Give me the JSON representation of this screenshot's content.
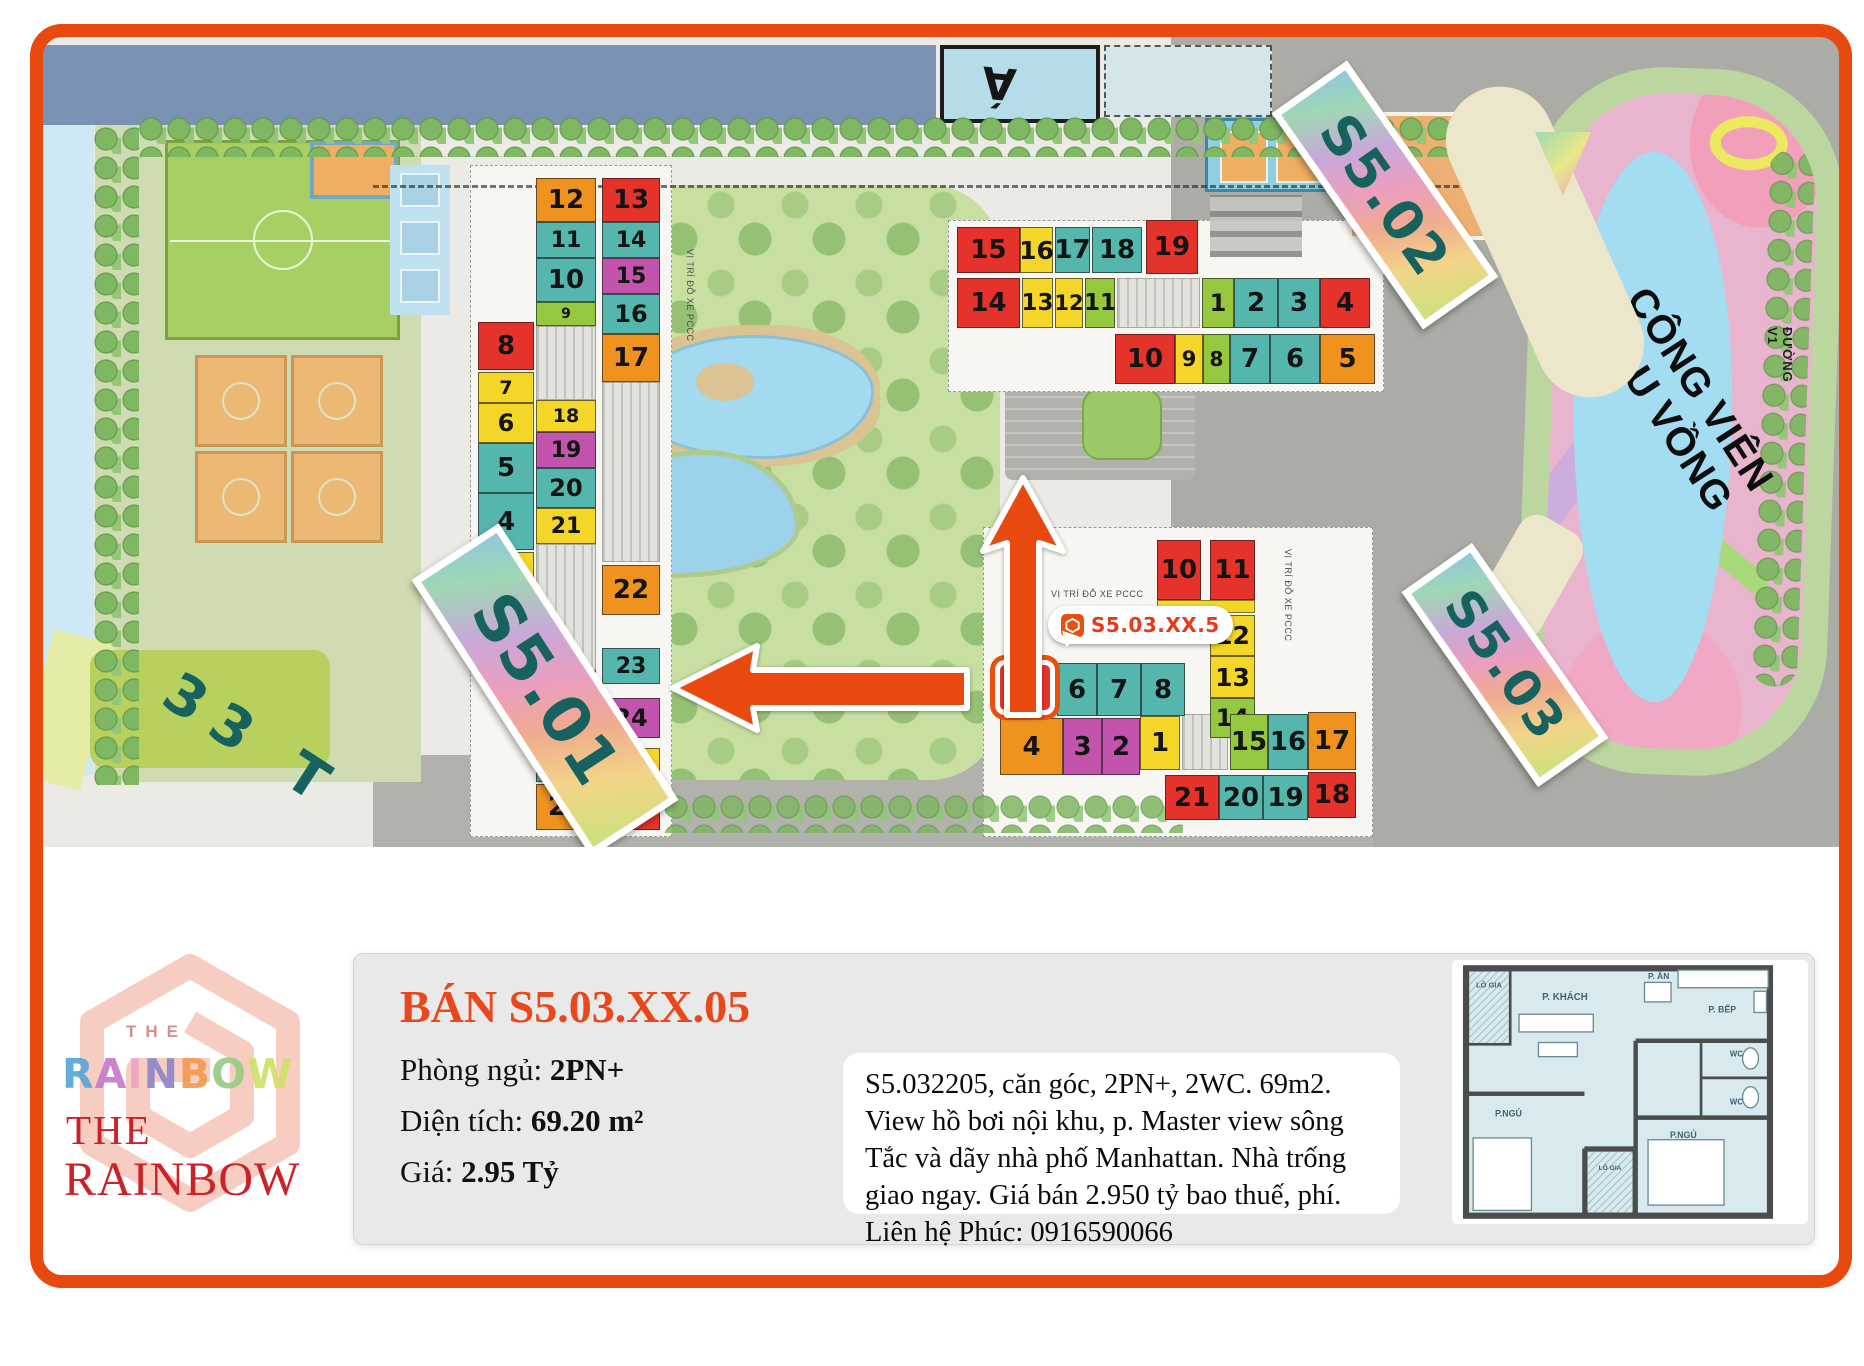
{
  "frame_color": "#e8490f",
  "map": {
    "pool_text": "Á",
    "tower_labels": {
      "s501": "S5.01",
      "s502": "S5.02",
      "s503": "S5.03"
    },
    "floors_label": "33 T",
    "park_name_line1": "CÔNG VIÊN",
    "park_name_line2": "CẦU VỒNG",
    "road_label": "ĐƯỜNG V1",
    "parking_note": "VỊ TRÍ ĐỖ XE PCCC",
    "unit_badge": {
      "text": "S5.03.XX.5"
    },
    "unit_colors": {
      "r": "#e5332b",
      "o": "#f0921e",
      "y": "#f3d627",
      "t": "#54b6ad",
      "g": "#95c83e",
      "m": "#c354ae"
    },
    "buildings": [
      {
        "id": "s501",
        "units": [
          {
            "n": "8",
            "c": "r",
            "x": 435,
            "y": 285,
            "w": 56,
            "h": 48
          },
          {
            "n": "7",
            "c": "y",
            "x": 435,
            "y": 335,
            "w": 56,
            "h": 31
          },
          {
            "n": "6",
            "c": "y",
            "x": 435,
            "y": 366,
            "w": 56,
            "h": 40
          },
          {
            "n": "5",
            "c": "t",
            "x": 435,
            "y": 406,
            "w": 56,
            "h": 50
          },
          {
            "n": "4",
            "c": "t",
            "x": 435,
            "y": 456,
            "w": 56,
            "h": 57
          },
          {
            "n": "3",
            "c": "y",
            "x": 435,
            "y": 515,
            "w": 56,
            "h": 36
          },
          {
            "n": "2",
            "c": "y",
            "x": 435,
            "y": 551,
            "w": 56,
            "h": 40
          },
          {
            "n": "1",
            "c": "r",
            "x": 435,
            "y": 593,
            "w": 56,
            "h": 50
          },
          {
            "n": "12",
            "c": "o",
            "x": 493,
            "y": 141,
            "w": 60,
            "h": 44
          },
          {
            "n": "11",
            "c": "t",
            "x": 493,
            "y": 185,
            "w": 60,
            "h": 36
          },
          {
            "n": "10",
            "c": "t",
            "x": 493,
            "y": 221,
            "w": 60,
            "h": 44
          },
          {
            "n": "9",
            "c": "g",
            "x": 493,
            "y": 265,
            "w": 60,
            "h": 24
          },
          {
            "n": "18",
            "c": "y",
            "x": 493,
            "y": 363,
            "w": 60,
            "h": 32
          },
          {
            "n": "19",
            "c": "m",
            "x": 493,
            "y": 395,
            "w": 60,
            "h": 36
          },
          {
            "n": "20",
            "c": "t",
            "x": 493,
            "y": 431,
            "w": 60,
            "h": 40
          },
          {
            "n": "21",
            "c": "y",
            "x": 493,
            "y": 471,
            "w": 60,
            "h": 36
          },
          {
            "n": "30",
            "c": "g",
            "x": 493,
            "y": 633,
            "w": 60,
            "h": 26
          },
          {
            "n": "29",
            "c": "t",
            "x": 493,
            "y": 659,
            "w": 60,
            "h": 42
          },
          {
            "n": "28",
            "c": "t",
            "x": 493,
            "y": 703,
            "w": 60,
            "h": 42
          },
          {
            "n": "27",
            "c": "o",
            "x": 493,
            "y": 747,
            "w": 60,
            "h": 46
          },
          {
            "n": "13",
            "c": "r",
            "x": 559,
            "y": 141,
            "w": 58,
            "h": 44
          },
          {
            "n": "14",
            "c": "t",
            "x": 559,
            "y": 185,
            "w": 58,
            "h": 36
          },
          {
            "n": "15",
            "c": "m",
            "x": 559,
            "y": 221,
            "w": 58,
            "h": 36
          },
          {
            "n": "16",
            "c": "t",
            "x": 559,
            "y": 257,
            "w": 58,
            "h": 40
          },
          {
            "n": "17",
            "c": "o",
            "x": 559,
            "y": 297,
            "w": 58,
            "h": 48
          },
          {
            "n": "22",
            "c": "o",
            "x": 559,
            "y": 528,
            "w": 58,
            "h": 50
          },
          {
            "n": "23",
            "c": "t",
            "x": 559,
            "y": 611,
            "w": 58,
            "h": 36
          },
          {
            "n": "24",
            "c": "m",
            "x": 559,
            "y": 661,
            "w": 58,
            "h": 40
          },
          {
            "n": "25",
            "c": "y",
            "x": 559,
            "y": 711,
            "w": 58,
            "h": 36
          },
          {
            "n": "26",
            "c": "r",
            "x": 559,
            "y": 751,
            "w": 58,
            "h": 42
          }
        ]
      },
      {
        "id": "s502",
        "units": [
          {
            "n": "15",
            "c": "r",
            "x": 914,
            "y": 190,
            "w": 63,
            "h": 46
          },
          {
            "n": "16",
            "c": "y",
            "x": 977,
            "y": 190,
            "w": 33,
            "h": 46
          },
          {
            "n": "17",
            "c": "t",
            "x": 1012,
            "y": 190,
            "w": 35,
            "h": 46
          },
          {
            "n": "18",
            "c": "t",
            "x": 1049,
            "y": 190,
            "w": 50,
            "h": 46
          },
          {
            "n": "19",
            "c": "r",
            "x": 1103,
            "y": 183,
            "w": 52,
            "h": 54
          },
          {
            "n": "14",
            "c": "r",
            "x": 914,
            "y": 241,
            "w": 63,
            "h": 50
          },
          {
            "n": "13",
            "c": "y",
            "x": 979,
            "y": 241,
            "w": 31,
            "h": 50
          },
          {
            "n": "12",
            "c": "y",
            "x": 1012,
            "y": 241,
            "w": 28,
            "h": 50
          },
          {
            "n": "11",
            "c": "g",
            "x": 1042,
            "y": 241,
            "w": 30,
            "h": 50
          },
          {
            "n": "1",
            "c": "g",
            "x": 1159,
            "y": 241,
            "w": 32,
            "h": 50
          },
          {
            "n": "2",
            "c": "t",
            "x": 1191,
            "y": 241,
            "w": 44,
            "h": 50
          },
          {
            "n": "3",
            "c": "t",
            "x": 1235,
            "y": 241,
            "w": 42,
            "h": 50
          },
          {
            "n": "4",
            "c": "r",
            "x": 1277,
            "y": 241,
            "w": 50,
            "h": 50
          },
          {
            "n": "10",
            "c": "r",
            "x": 1072,
            "y": 297,
            "w": 60,
            "h": 50
          },
          {
            "n": "9",
            "c": "y",
            "x": 1132,
            "y": 297,
            "w": 28,
            "h": 50
          },
          {
            "n": "8",
            "c": "g",
            "x": 1160,
            "y": 297,
            "w": 27,
            "h": 50
          },
          {
            "n": "7",
            "c": "t",
            "x": 1187,
            "y": 297,
            "w": 40,
            "h": 50
          },
          {
            "n": "6",
            "c": "t",
            "x": 1227,
            "y": 297,
            "w": 50,
            "h": 50
          },
          {
            "n": "5",
            "c": "o",
            "x": 1277,
            "y": 297,
            "w": 55,
            "h": 50
          }
        ]
      },
      {
        "id": "s503",
        "strips": [
          {
            "c": "y",
            "x": 1114,
            "y": 563,
            "w": 98,
            "h": 13
          }
        ],
        "units": [
          {
            "n": "10",
            "c": "r",
            "x": 1114,
            "y": 503,
            "w": 44,
            "h": 60
          },
          {
            "n": "11",
            "c": "r",
            "x": 1167,
            "y": 503,
            "w": 45,
            "h": 60
          },
          {
            "n": "12",
            "c": "y",
            "x": 1167,
            "y": 578,
            "w": 45,
            "h": 41
          },
          {
            "n": "13",
            "c": "y",
            "x": 1167,
            "y": 619,
            "w": 45,
            "h": 42
          },
          {
            "n": "14",
            "c": "g",
            "x": 1167,
            "y": 661,
            "w": 45,
            "h": 40
          },
          {
            "n": "5",
            "c": "r",
            "x": 952,
            "y": 623,
            "w": 60,
            "h": 55,
            "hl": true
          },
          {
            "n": "6",
            "c": "t",
            "x": 1014,
            "y": 626,
            "w": 40,
            "h": 53
          },
          {
            "n": "7",
            "c": "t",
            "x": 1054,
            "y": 626,
            "w": 44,
            "h": 53
          },
          {
            "n": "8",
            "c": "t",
            "x": 1098,
            "y": 626,
            "w": 44,
            "h": 53
          },
          {
            "n": "4",
            "c": "o",
            "x": 957,
            "y": 681,
            "w": 63,
            "h": 57
          },
          {
            "n": "3",
            "c": "m",
            "x": 1020,
            "y": 681,
            "w": 39,
            "h": 57
          },
          {
            "n": "2",
            "c": "m",
            "x": 1059,
            "y": 681,
            "w": 38,
            "h": 57
          },
          {
            "n": "1",
            "c": "y",
            "x": 1097,
            "y": 679,
            "w": 40,
            "h": 54
          },
          {
            "n": "15",
            "c": "g",
            "x": 1187,
            "y": 677,
            "w": 38,
            "h": 56
          },
          {
            "n": "16",
            "c": "t",
            "x": 1225,
            "y": 677,
            "w": 40,
            "h": 56
          },
          {
            "n": "17",
            "c": "o",
            "x": 1265,
            "y": 675,
            "w": 48,
            "h": 58
          },
          {
            "n": "21",
            "c": "r",
            "x": 1122,
            "y": 738,
            "w": 54,
            "h": 45
          },
          {
            "n": "20",
            "c": "t",
            "x": 1176,
            "y": 738,
            "w": 44,
            "h": 45
          },
          {
            "n": "19",
            "c": "t",
            "x": 1220,
            "y": 738,
            "w": 45,
            "h": 45
          },
          {
            "n": "18",
            "c": "r",
            "x": 1265,
            "y": 735,
            "w": 48,
            "h": 46
          }
        ]
      }
    ]
  },
  "info": {
    "title": "BÁN S5.03.XX.05",
    "fields": [
      {
        "label": "Phòng ngủ: ",
        "value": "2PN+"
      },
      {
        "label": "Diện tích: ",
        "value": "69.20 m²"
      },
      {
        "label": "Giá: ",
        "value": "2.95 Tỷ"
      }
    ],
    "description": "S5.032205, căn góc, 2PN+, 2WC. 69m2. View hồ bơi nội khu, p. Master view sông Tắc và dãy nhà phố Manhattan. Nhà trống giao ngay. Giá bán 2.950 tỷ bao thuế, phí. Liên hệ Phúc: 0916590066"
  },
  "logo": {
    "the_top": "THE",
    "rainbow_top": "RAINBOW",
    "rainbow_top_colors": [
      "#57a7d8",
      "#c77bc8",
      "#f0a3c0",
      "#8f86c8",
      "#f29b50",
      "#99cc80",
      "#cfe06a"
    ],
    "the_main": "THE",
    "rainbow_main": "RAINBOW"
  },
  "floorplan": {
    "rooms": {
      "balcony1": "LÔ GIA",
      "living": "P. KHÁCH",
      "dining": "P. ĂN",
      "kitchen": "P. BẾP",
      "wc1": "WC",
      "wc2": "WC",
      "bed1": "P.NGỦ",
      "balcony2": "LÔ GIA",
      "bed2": "P.NGỦ"
    }
  }
}
